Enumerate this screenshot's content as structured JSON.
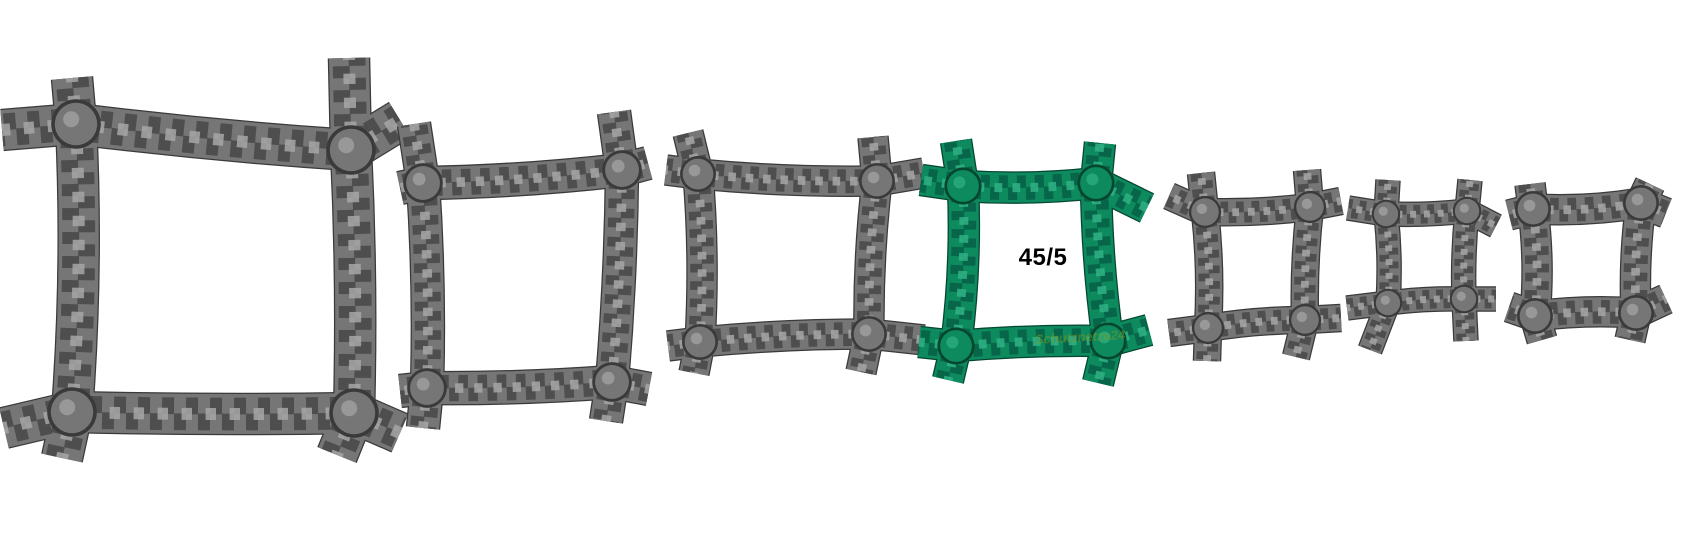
{
  "gallery": {
    "background": "#ffffff",
    "mesh_count": 7,
    "selected_index": 3
  },
  "palette": {
    "gray": {
      "edge": "#3a3a3a",
      "base": "#767676",
      "dark": "#4a4a4a",
      "light": "#a7a7a7"
    },
    "green": {
      "edge": "#05462f",
      "base": "#0e8a5f",
      "dark": "#076247",
      "light": "#2fb284"
    }
  },
  "label": {
    "text": "45/5",
    "x": 1043,
    "y": 258,
    "font_size": 24,
    "color": "#000000"
  },
  "watermark": {
    "text": "Schutznetze24",
    "x": 1080,
    "y": 337,
    "font_size": 13,
    "color": "#7f9a25",
    "opacity": 0.5
  },
  "meshes": [
    {
      "name": "mesh-option-1",
      "color": "gray",
      "t": 40,
      "selected": false,
      "corners": [
        [
          76,
          124
        ],
        [
          351,
          150
        ],
        [
          354,
          413
        ],
        [
          72,
          412
        ]
      ],
      "bulges": [
        -4,
        5,
        3,
        -9
      ],
      "stubs": [
        [
          76,
          124,
          72,
          78
        ],
        [
          76,
          124,
          2,
          130
        ],
        [
          351,
          150,
          349,
          58
        ],
        [
          351,
          150,
          400,
          120
        ],
        [
          354,
          413,
          337,
          455
        ],
        [
          354,
          413,
          400,
          433
        ],
        [
          72,
          412,
          62,
          458
        ],
        [
          72,
          412,
          4,
          428
        ]
      ]
    },
    {
      "name": "mesh-option-2",
      "color": "gray",
      "t": 32,
      "selected": false,
      "corners": [
        [
          423,
          183
        ],
        [
          622,
          170
        ],
        [
          612,
          382
        ],
        [
          427,
          388
        ]
      ],
      "bulges": [
        -5,
        4,
        4,
        -5
      ],
      "stubs": [
        [
          423,
          183,
          414,
          124
        ],
        [
          423,
          183,
          400,
          188
        ],
        [
          622,
          170,
          614,
          112
        ],
        [
          622,
          170,
          648,
          163
        ],
        [
          612,
          382,
          606,
          421
        ],
        [
          612,
          382,
          649,
          389
        ],
        [
          427,
          388,
          423,
          428
        ],
        [
          427,
          388,
          400,
          391
        ]
      ]
    },
    {
      "name": "mesh-option-3",
      "color": "gray",
      "t": 29,
      "selected": false,
      "corners": [
        [
          698,
          174
        ],
        [
          877,
          181
        ],
        [
          869,
          334
        ],
        [
          700,
          342
        ]
      ],
      "bulges": [
        -5,
        -5,
        -4,
        -6
      ],
      "stubs": [
        [
          698,
          174,
          688,
          133
        ],
        [
          698,
          174,
          666,
          170
        ],
        [
          877,
          181,
          873,
          137
        ],
        [
          877,
          181,
          924,
          173
        ],
        [
          869,
          334,
          861,
          372
        ],
        [
          869,
          334,
          924,
          340
        ],
        [
          700,
          342,
          694,
          373
        ],
        [
          700,
          342,
          668,
          346
        ]
      ]
    },
    {
      "name": "mesh-option-4",
      "color": "green",
      "t": 30,
      "selected": true,
      "corners": [
        [
          963,
          186
        ],
        [
          1096,
          183
        ],
        [
          1108,
          341
        ],
        [
          956,
          346
        ]
      ],
      "bulges": [
        -6,
        -5,
        -4,
        -7
      ],
      "stubs": [
        [
          963,
          186,
          956,
          141
        ],
        [
          963,
          186,
          921,
          180
        ],
        [
          1096,
          183,
          1100,
          143
        ],
        [
          1096,
          183,
          1147,
          208
        ],
        [
          1108,
          341,
          1098,
          383
        ],
        [
          1108,
          341,
          1149,
          330
        ],
        [
          956,
          346,
          948,
          380
        ],
        [
          956,
          346,
          919,
          342
        ]
      ]
    },
    {
      "name": "mesh-option-5",
      "color": "gray",
      "t": 26,
      "selected": false,
      "corners": [
        [
          1205,
          212
        ],
        [
          1310,
          207
        ],
        [
          1305,
          320
        ],
        [
          1208,
          328
        ]
      ],
      "bulges": [
        -4,
        -4,
        -4,
        -5
      ],
      "stubs": [
        [
          1205,
          212,
          1201,
          173
        ],
        [
          1205,
          212,
          1169,
          196
        ],
        [
          1310,
          207,
          1307,
          170
        ],
        [
          1310,
          207,
          1341,
          201
        ],
        [
          1305,
          320,
          1296,
          357
        ],
        [
          1305,
          320,
          1341,
          318
        ],
        [
          1208,
          328,
          1207,
          361
        ],
        [
          1208,
          328,
          1169,
          333
        ]
      ]
    },
    {
      "name": "mesh-option-6",
      "color": "gray",
      "t": 23,
      "selected": false,
      "corners": [
        [
          1386,
          214
        ],
        [
          1467,
          211
        ],
        [
          1464,
          299
        ],
        [
          1388,
          303
        ]
      ],
      "bulges": [
        -3,
        -3,
        -3,
        -4
      ],
      "stubs": [
        [
          1386,
          214,
          1388,
          180
        ],
        [
          1386,
          214,
          1348,
          208
        ],
        [
          1467,
          211,
          1470,
          180
        ],
        [
          1467,
          211,
          1496,
          226
        ],
        [
          1464,
          299,
          1466,
          341
        ],
        [
          1464,
          299,
          1496,
          299
        ],
        [
          1388,
          303,
          1370,
          350
        ],
        [
          1388,
          303,
          1347,
          308
        ]
      ]
    },
    {
      "name": "mesh-option-7",
      "color": "gray",
      "t": 29,
      "selected": false,
      "corners": [
        [
          1533,
          209
        ],
        [
          1641,
          203
        ],
        [
          1636,
          313
        ],
        [
          1535,
          316
        ]
      ],
      "bulges": [
        -6,
        -5,
        -5,
        -6
      ],
      "stubs": [
        [
          1533,
          209,
          1530,
          184
        ],
        [
          1533,
          209,
          1509,
          215
        ],
        [
          1641,
          203,
          1650,
          184
        ],
        [
          1641,
          203,
          1666,
          213
        ],
        [
          1636,
          313,
          1630,
          340
        ],
        [
          1636,
          313,
          1666,
          299
        ],
        [
          1535,
          316,
          1542,
          340
        ],
        [
          1535,
          316,
          1509,
          307
        ]
      ]
    }
  ]
}
